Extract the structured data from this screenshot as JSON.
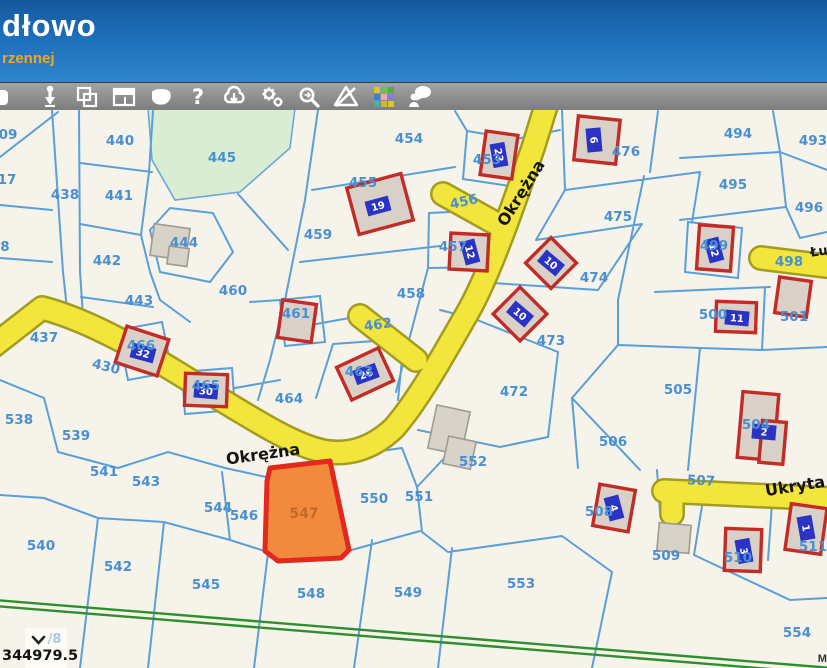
{
  "header": {
    "title": "dłowo",
    "subtitle": "rzennej"
  },
  "toolbar": {
    "help_glyph": "?",
    "icons": [
      "partial-tool",
      "pin-marker",
      "copy-frames",
      "layout-panels",
      "polygon-balloon",
      "help",
      "cloud-download",
      "settings-gears",
      "zoom-search",
      "warning-slash",
      "legend-colors",
      "user-feedback"
    ]
  },
  "map": {
    "colors": {
      "bg": "#f6f3ea",
      "line": "#5b9fd8",
      "label": "#4a90d0",
      "road_fill": "#f2e63c",
      "road_edge": "#a39c20",
      "green_area": "#d8edd2",
      "green_line": "#2f8f2f",
      "building_fill": "#d9d0c7",
      "building_edge": "#c32b26",
      "gray_fill": "#d8d3c9",
      "gray_edge": "#a09a90",
      "plate_fill": "#2b33c4"
    },
    "street_labels": [
      {
        "t": "Okrężna",
        "x": 521,
        "y": 193,
        "r": -58
      },
      {
        "t": "Okrężna",
        "x": 263,
        "y": 454,
        "r": -8
      },
      {
        "t": "Ukryta",
        "x": 795,
        "y": 486,
        "r": -9
      },
      {
        "t": "Łu",
        "x": 819,
        "y": 252,
        "r": -8,
        "size": 13
      }
    ],
    "parcel_labels": [
      {
        "t": "09",
        "x": 8,
        "y": 135
      },
      {
        "t": "440",
        "x": 120,
        "y": 141
      },
      {
        "t": "445",
        "x": 222,
        "y": 158
      },
      {
        "t": "454",
        "x": 409,
        "y": 139
      },
      {
        "t": "453",
        "x": 487,
        "y": 160
      },
      {
        "t": "476",
        "x": 626,
        "y": 152
      },
      {
        "t": "494",
        "x": 738,
        "y": 134
      },
      {
        "t": "493",
        "x": 813,
        "y": 141
      },
      {
        "t": "17",
        "x": 7,
        "y": 180
      },
      {
        "t": "438",
        "x": 65,
        "y": 195
      },
      {
        "t": "441",
        "x": 119,
        "y": 196
      },
      {
        "t": "455",
        "x": 363,
        "y": 183
      },
      {
        "t": "495",
        "x": 733,
        "y": 185
      },
      {
        "t": "456",
        "x": 464,
        "y": 202,
        "r": -12
      },
      {
        "t": "459",
        "x": 318,
        "y": 235
      },
      {
        "t": "444",
        "x": 184,
        "y": 243
      },
      {
        "t": "457",
        "x": 453,
        "y": 247
      },
      {
        "t": "499",
        "x": 714,
        "y": 246
      },
      {
        "t": "8",
        "x": 5,
        "y": 247
      },
      {
        "t": "496",
        "x": 809,
        "y": 208
      },
      {
        "t": "475",
        "x": 618,
        "y": 217
      },
      {
        "t": "442",
        "x": 107,
        "y": 261
      },
      {
        "t": "460",
        "x": 233,
        "y": 291
      },
      {
        "t": "458",
        "x": 411,
        "y": 294
      },
      {
        "t": "498",
        "x": 789,
        "y": 262
      },
      {
        "t": "474",
        "x": 594,
        "y": 278
      },
      {
        "t": "443",
        "x": 139,
        "y": 301
      },
      {
        "t": "461",
        "x": 296,
        "y": 314
      },
      {
        "t": "462",
        "x": 378,
        "y": 325,
        "r": -8
      },
      {
        "t": "437",
        "x": 44,
        "y": 338
      },
      {
        "t": "466",
        "x": 141,
        "y": 346
      },
      {
        "t": "473",
        "x": 551,
        "y": 341
      },
      {
        "t": "501",
        "x": 794,
        "y": 317
      },
      {
        "t": "500",
        "x": 713,
        "y": 315
      },
      {
        "t": "430",
        "x": 106,
        "y": 367,
        "r": 14
      },
      {
        "t": "465",
        "x": 206,
        "y": 386
      },
      {
        "t": "463",
        "x": 359,
        "y": 372
      },
      {
        "t": "464",
        "x": 289,
        "y": 399
      },
      {
        "t": "472",
        "x": 514,
        "y": 392
      },
      {
        "t": "505",
        "x": 678,
        "y": 390
      },
      {
        "t": "538",
        "x": 19,
        "y": 420
      },
      {
        "t": "539",
        "x": 76,
        "y": 436
      },
      {
        "t": "506",
        "x": 613,
        "y": 442
      },
      {
        "t": "504",
        "x": 756,
        "y": 425
      },
      {
        "t": "552",
        "x": 473,
        "y": 462
      },
      {
        "t": "550",
        "x": 374,
        "y": 499
      },
      {
        "t": "551",
        "x": 419,
        "y": 497
      },
      {
        "t": "507",
        "x": 701,
        "y": 481,
        "r": 3
      },
      {
        "t": "541",
        "x": 104,
        "y": 472
      },
      {
        "t": "543",
        "x": 146,
        "y": 482
      },
      {
        "t": "544",
        "x": 218,
        "y": 508
      },
      {
        "t": "546",
        "x": 244,
        "y": 516
      },
      {
        "t": "508",
        "x": 599,
        "y": 512
      },
      {
        "t": "540",
        "x": 41,
        "y": 546
      },
      {
        "t": "542",
        "x": 118,
        "y": 567
      },
      {
        "t": "545",
        "x": 206,
        "y": 585
      },
      {
        "t": "509",
        "x": 666,
        "y": 556
      },
      {
        "t": "510",
        "x": 738,
        "y": 558
      },
      {
        "t": "511",
        "x": 813,
        "y": 547
      },
      {
        "t": "548",
        "x": 311,
        "y": 594
      },
      {
        "t": "549",
        "x": 408,
        "y": 593
      },
      {
        "t": "553",
        "x": 521,
        "y": 584
      },
      {
        "t": "554",
        "x": 797,
        "y": 633
      }
    ],
    "buildings": [
      {
        "x": 352,
        "y": 180,
        "w": 56,
        "h": 48,
        "rot": -15,
        "plate": "19",
        "prot": -15,
        "px": 378,
        "py": 206
      },
      {
        "x": 483,
        "y": 133,
        "w": 32,
        "h": 44,
        "rot": 8,
        "plate": "23",
        "prot": 80,
        "px": 499,
        "py": 155
      },
      {
        "x": 576,
        "y": 118,
        "w": 42,
        "h": 44,
        "rot": 6,
        "plate": "6",
        "prot": 85,
        "px": 594,
        "py": 140
      },
      {
        "x": 450,
        "y": 234,
        "w": 38,
        "h": 36,
        "rot": 3,
        "plate": "12",
        "prot": 75,
        "px": 470,
        "py": 252
      },
      {
        "x": 533,
        "y": 245,
        "w": 36,
        "h": 36,
        "rot": 45,
        "plate": "10",
        "prot": 40,
        "px": 551,
        "py": 263
      },
      {
        "x": 501,
        "y": 295,
        "w": 38,
        "h": 38,
        "rot": 45,
        "plate": "10",
        "prot": 40,
        "px": 520,
        "py": 314
      },
      {
        "x": 698,
        "y": 226,
        "w": 34,
        "h": 44,
        "rot": 4,
        "plate": "12",
        "prot": 75,
        "px": 714,
        "py": 250
      },
      {
        "x": 716,
        "y": 302,
        "w": 40,
        "h": 30,
        "rot": 2,
        "plate": "11",
        "prot": 5,
        "px": 737,
        "py": 318
      },
      {
        "x": 777,
        "y": 279,
        "w": 32,
        "h": 36,
        "rot": 8
      },
      {
        "x": 120,
        "y": 332,
        "w": 44,
        "h": 38,
        "rot": 18,
        "plate": "32",
        "prot": 15,
        "px": 143,
        "py": 353
      },
      {
        "x": 185,
        "y": 374,
        "w": 42,
        "h": 32,
        "rot": 2,
        "plate": "30",
        "prot": 5,
        "px": 206,
        "py": 391
      },
      {
        "x": 342,
        "y": 356,
        "w": 46,
        "h": 36,
        "rot": -25,
        "plate": "26",
        "prot": -20,
        "px": 366,
        "py": 374
      },
      {
        "x": 280,
        "y": 302,
        "w": 34,
        "h": 38,
        "rot": 8
      },
      {
        "x": 740,
        "y": 393,
        "w": 36,
        "h": 66,
        "rot": 5,
        "extra": [
          762,
          420,
          24,
          42
        ],
        "plate": "2",
        "prot": 5,
        "px": 764,
        "py": 432
      },
      {
        "x": 596,
        "y": 487,
        "w": 36,
        "h": 42,
        "rot": 10,
        "plate": "4",
        "prot": 75,
        "px": 614,
        "py": 508
      },
      {
        "x": 725,
        "y": 529,
        "w": 36,
        "h": 42,
        "rot": 2,
        "plate": "3",
        "prot": 80,
        "px": 744,
        "py": 551
      },
      {
        "x": 788,
        "y": 506,
        "w": 36,
        "h": 46,
        "rot": 8,
        "plate": "1",
        "prot": 80,
        "px": 806,
        "py": 528
      },
      {
        "type": "gray",
        "x": 152,
        "y": 226,
        "w": 36,
        "h": 32,
        "rot": 8,
        "extra": [
          170,
          246,
          20,
          18
        ]
      },
      {
        "type": "gray",
        "x": 432,
        "y": 408,
        "w": 34,
        "h": 44,
        "rot": 12,
        "extra": [
          450,
          436,
          28,
          28
        ]
      },
      {
        "type": "gray",
        "x": 658,
        "y": 524,
        "w": 32,
        "h": 28,
        "rot": 5
      }
    ],
    "highlight": {
      "label": "547",
      "x": 304,
      "y": 514,
      "fill": "#f28a3e",
      "border": "#e3281e",
      "label_color": "#c06a28"
    },
    "status": {
      "page_fragment": "/8",
      "coordinate": "344979.5"
    },
    "attribution": "Ma"
  }
}
